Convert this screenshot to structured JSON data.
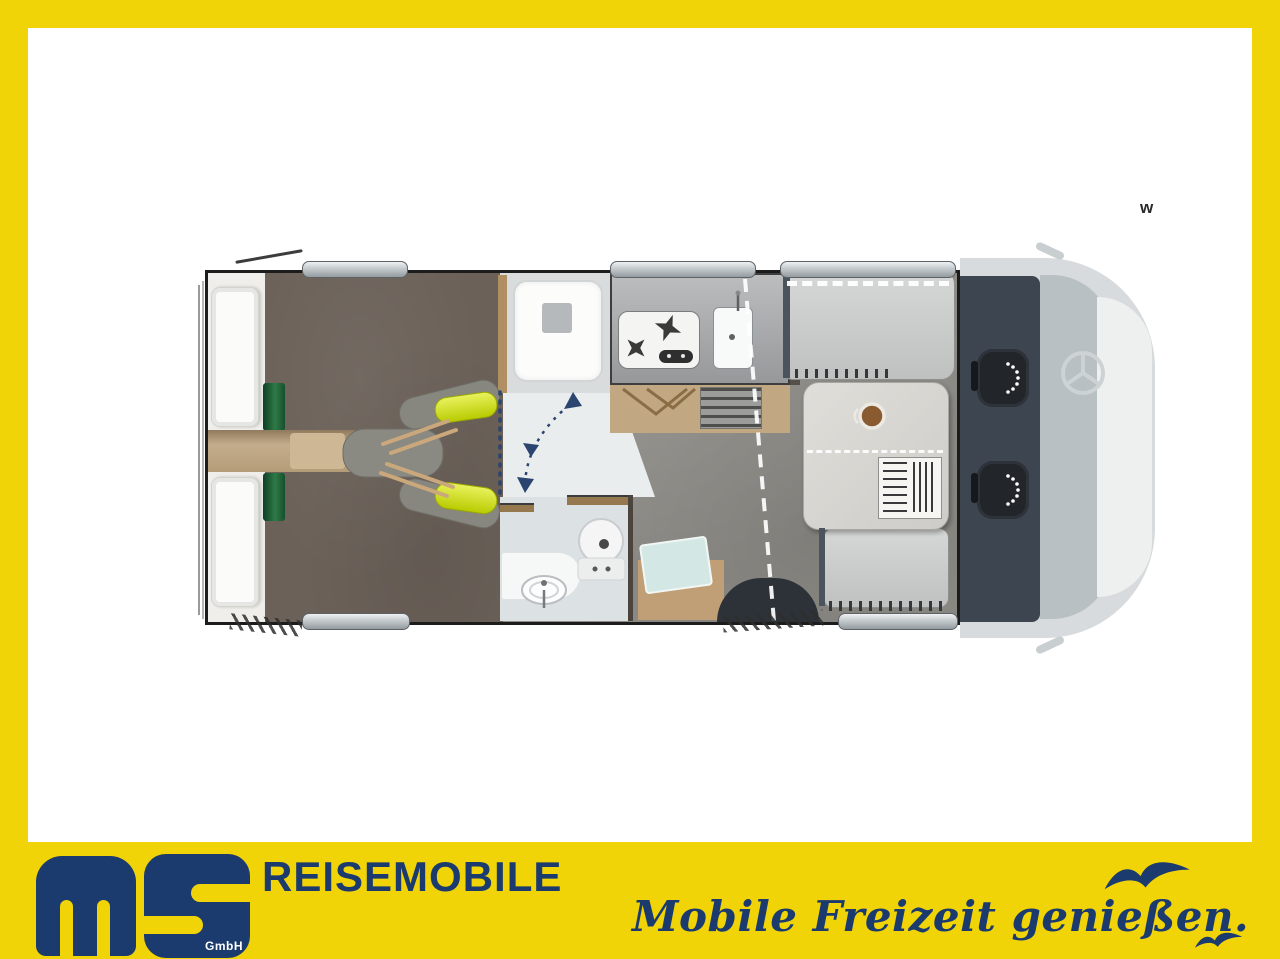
{
  "page": {
    "frame_color": "#F0D408",
    "content_background": "#FFFFFF",
    "watermark_letter": "w"
  },
  "brand": {
    "logo_text": "ms",
    "logo_gmbh": "GmbH",
    "company_name": "REISEMOBILE",
    "slogan": "Mobile Freizeit genießen.",
    "navy": "#1B3A6E",
    "yellow": "#F0D408",
    "bird_icons": 2
  },
  "floorplan": {
    "description": "Motorhome top-view floor plan with cab at right",
    "rooms": [
      {
        "name": "rear-twin-beds",
        "color": "#6B6159"
      },
      {
        "name": "shower-cabin",
        "color": "#FBFBFA"
      },
      {
        "name": "kitchen-hob-and-sink",
        "color": "#A4A5A6"
      },
      {
        "name": "bathroom-toilet-washbasin",
        "color": "#DCE1E4"
      },
      {
        "name": "half-dinette-with-table",
        "color": "#D8D6D2"
      },
      {
        "name": "entry-door-step",
        "color": "#2C3237"
      },
      {
        "name": "cab-with-two-swivel-seats",
        "color": "#3D4550"
      }
    ],
    "accents": {
      "bed_runner_green": "#1E5C38",
      "cushion_yellow": "#D8E23A",
      "wood_tone": "#C09E76",
      "door_swing_dash": "#2B4570"
    }
  }
}
